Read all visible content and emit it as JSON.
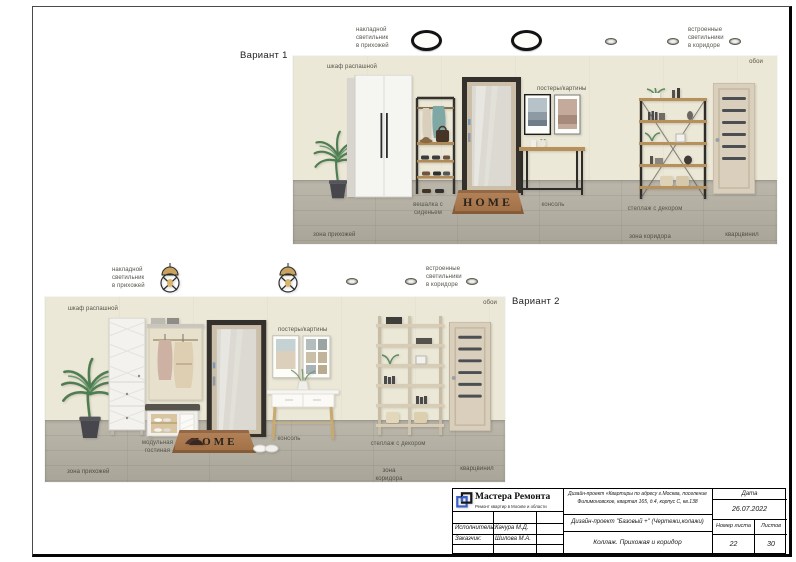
{
  "variant1": {
    "title": "Вариант 1",
    "surface_light_label": "накладной\nсветильник\nв прихожей",
    "recessed_light_label": "встроенные\nсветильники\nв коридоре",
    "wallpaper_label": "обои",
    "wardrobe_label": "шкаф распашной",
    "rack_label": "вешалка с\nсиденьем",
    "posters_label": "постеры/картины",
    "console_label": "консоль",
    "shelf_label": "стеллаж с декором",
    "hall_zone_label": "зона прихожей",
    "corridor_zone_label": "зона коридора",
    "floor_label": "кварцвинил",
    "doormat_text": "HOME"
  },
  "variant2": {
    "title": "Вариант 2",
    "surface_light_label": "накладной\nсветильник\nв прихожей",
    "recessed_light_label": "встроенные\nсветильники\nв коридоре",
    "wallpaper_label": "обои",
    "wardrobe_label": "шкаф распашной",
    "unit_label": "модульная\nгостиная",
    "posters_label": "постеры/картины",
    "console_label": "консоль",
    "shelf_label": "стеллаж с декором",
    "hall_zone_label": "зона прихожей",
    "corridor_zone_label": "зона коридора",
    "floor_label": "кварцвинил",
    "doormat_text": "HOME"
  },
  "titleblock": {
    "company_name": "Мастера Ремонта",
    "company_tagline": "Ремонт квартир в Москве и области",
    "project_address": "Дизайн-проект «Квартиры по адресу г.Москва, поселение Филимоновское, квартал 165, д.4, корпус С, кв.138",
    "project_name": "Дизайн-проект \"Базовый +\" (Чертежи,колажи)",
    "sheet_name": "Коллаж. Прихожая и коридор",
    "date_label": "Дата",
    "date_value": "26.07.2022",
    "sheet_number_label": "Номер листа",
    "sheets_total_label": "Листов",
    "sheet_number": "22",
    "sheets_total": "30",
    "executor_label": "Исполнитель:",
    "executor_name": "Качура М.Д.",
    "client_label": "Заказчик:",
    "client_name": "Шилова М.А."
  },
  "icons": {
    "ceiling_light": "surface-mounted round black-ring light",
    "recessed_light": "small built-in spot light",
    "pendant_lamp": "caged pendant lamp with brass shade",
    "company_logo": "two interlocked squares, blue and black"
  },
  "colors": {
    "accent_blue": "#3a62c4",
    "wall_beige": "#ece8d7",
    "floor_gray": "#b2ada0",
    "mat_brown": "#ad7950"
  }
}
